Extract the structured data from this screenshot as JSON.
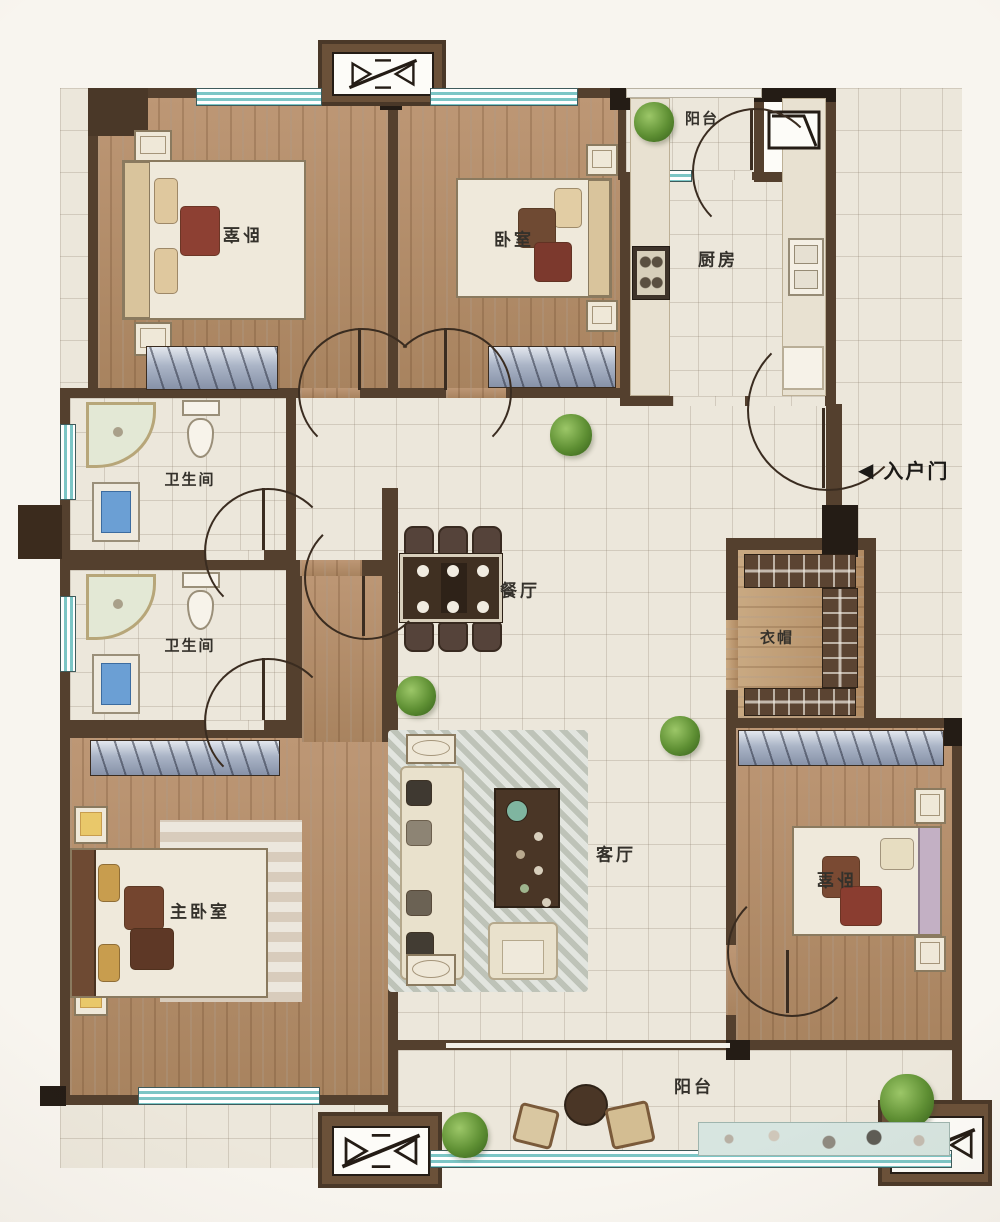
{
  "labels": {
    "bedroom_top_left": "卧室",
    "bedroom_top_mid": "卧室",
    "bedroom_bottom_right": "卧室",
    "master_bedroom": "主卧室",
    "kitchen": "厨房",
    "bathroom_1": "卫生间",
    "bathroom_2": "卫生间",
    "dining": "餐厅",
    "living": "客厅",
    "cloakroom": "衣帽",
    "balcony_top": "阳台",
    "balcony_bottom": "阳台",
    "entrance": "入户门",
    "entrance_arrow": "◀"
  },
  "colors": {
    "wall": "#54402e",
    "wall_dark": "#241c15",
    "wood_floor": "#b4906c",
    "tile_floor": "#ece7db",
    "window_teal": "#7cc6c6",
    "label_text": "#34312b",
    "sink_blue": "#6b9fd4",
    "plant_green": "#5f9338",
    "pillow_red": "#8d4033",
    "pillow_gold": "#c89d4e"
  }
}
